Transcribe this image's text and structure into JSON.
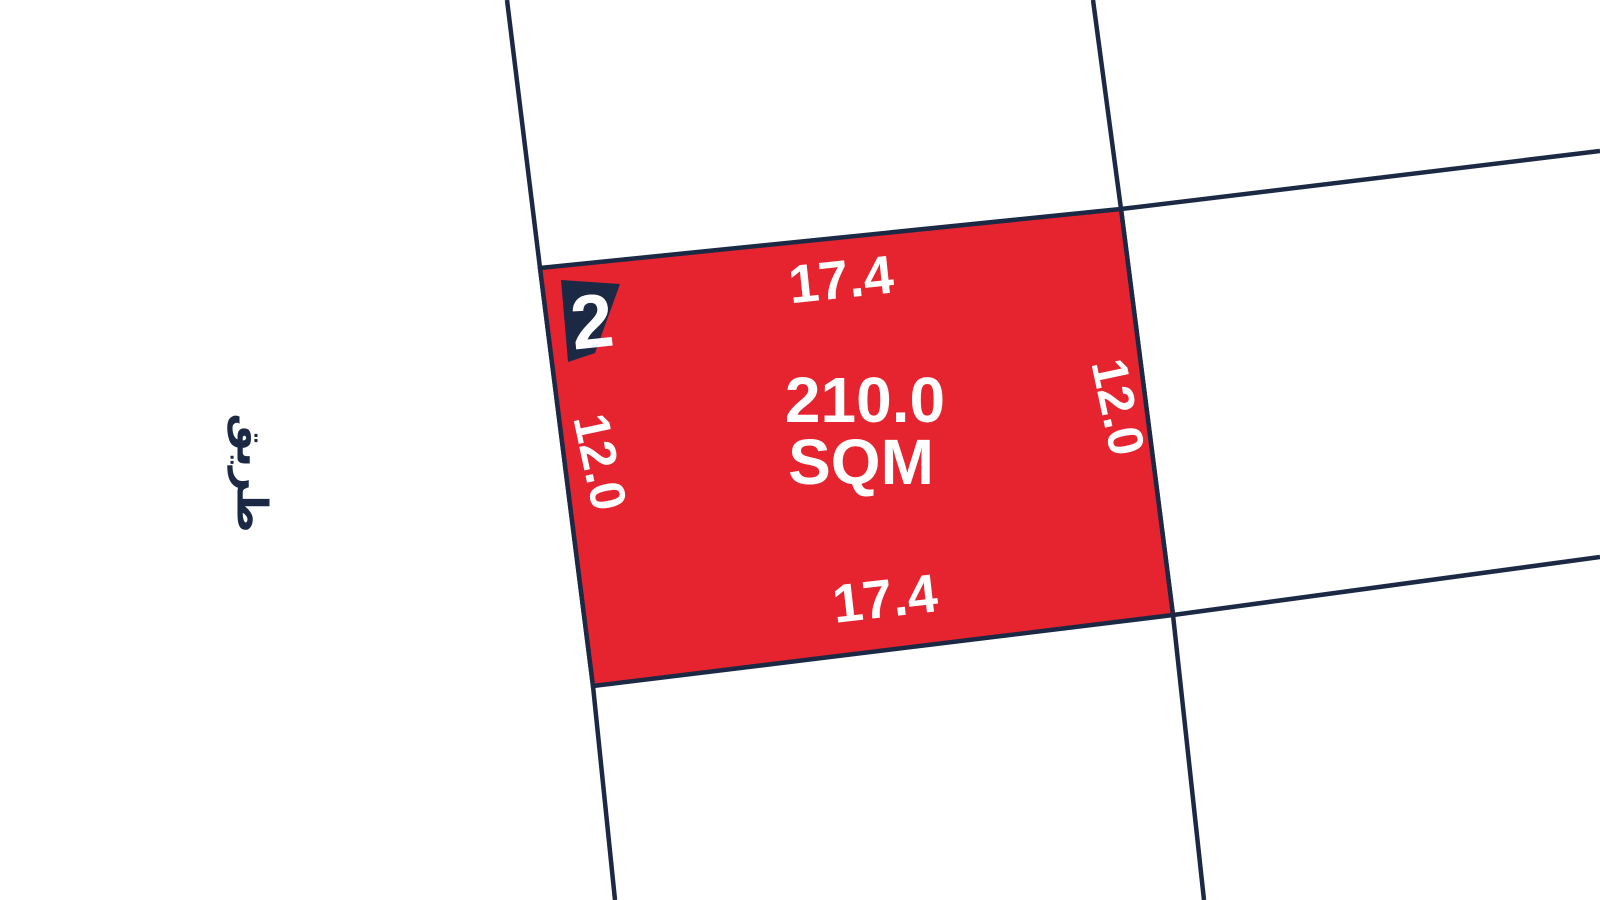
{
  "colors": {
    "background": "#ffffff",
    "boundary_line": "#1c2945",
    "parcel_fill": "#e62430",
    "parcel_label": "#ffffff"
  },
  "parcel": {
    "number": "2",
    "area_value": "210.0",
    "area_unit": "SQM",
    "dimensions": {
      "top": "17.4",
      "bottom": "17.4",
      "left": "12.0",
      "right": "12.0"
    }
  },
  "road_label": "طريق"
}
